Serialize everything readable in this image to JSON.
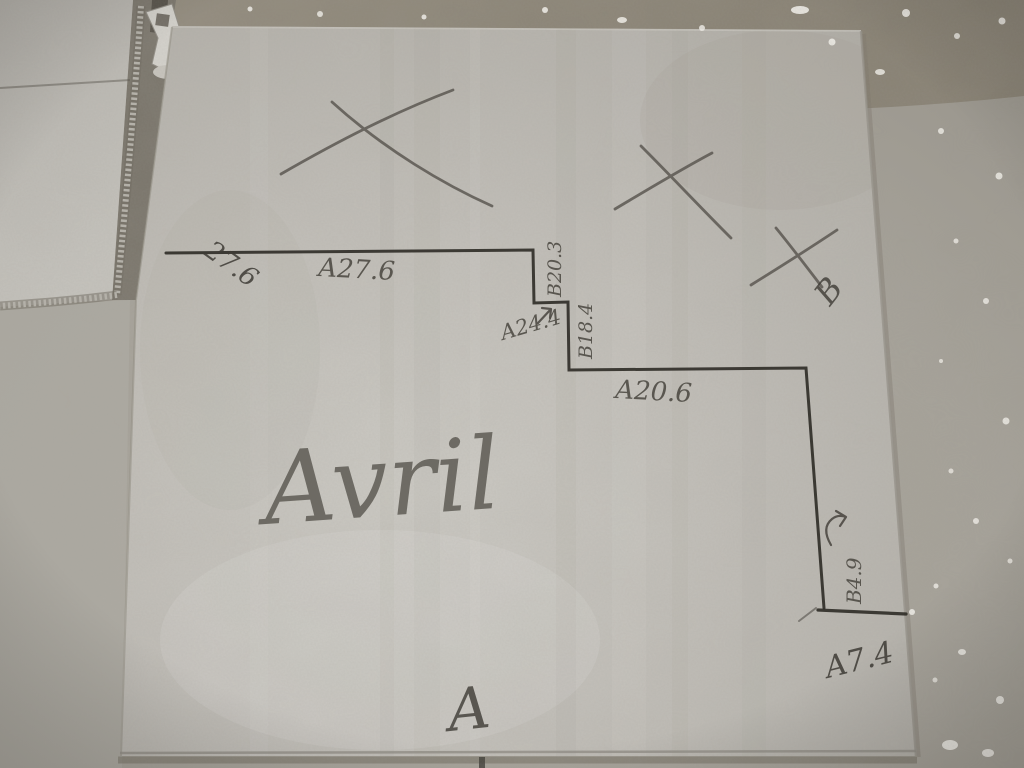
{
  "colors": {
    "tile_surface": "#c1beb8",
    "tile_highlight": "#d3d1cb",
    "left_tile": "#b9b6b0",
    "floor_dark_strip": "#8b8476",
    "floor_light": "#a7a39a",
    "pencil_dark": "#2e2b26",
    "pencil_mid": "#54504a",
    "handwriting": "#4c4942",
    "debris_white": "#f2f0ea",
    "metal_clip": "#d7d5cf"
  },
  "markings": {
    "top_edge_label": "27.6",
    "seg_a1": "A27.6",
    "seg_b1": "B20.3",
    "seg_a2": "A24.4",
    "seg_b2": "B18.4",
    "seg_a3": "A20.6",
    "seg_b3": "B4.9",
    "seg_a4": "A7.4",
    "name": "Avril",
    "letter_a": "A",
    "letter_b": "B",
    "cross_count": 3
  }
}
